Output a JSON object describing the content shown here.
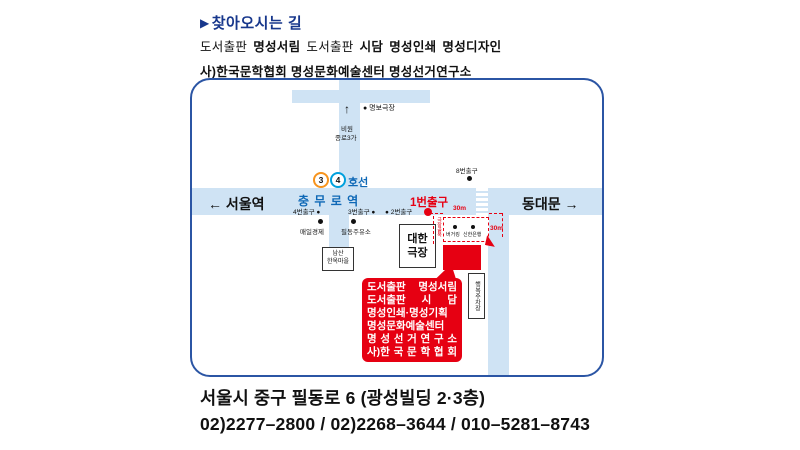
{
  "colors": {
    "accent_red": "#e60012",
    "navy_blue": "#17378c",
    "map_border_blue": "#2b55a4",
    "road_blue": "#cfe3f4",
    "station_blue": "#0e68b6",
    "line3_orange": "#f7941d",
    "line4_blue": "#00a0dd"
  },
  "header": {
    "title_icon": "▶",
    "title": "찾아오시는 길",
    "orgs_line1_segments": [
      {
        "text": "도서출판",
        "style": "serif"
      },
      {
        "text": "명성서림",
        "style": "bold"
      },
      {
        "text": "도서출판",
        "style": "serif"
      },
      {
        "text": "시담",
        "style": "bold"
      },
      {
        "text": "명성인쇄",
        "style": "bold"
      },
      {
        "text": "명성디자인",
        "style": "bold"
      }
    ],
    "orgs_line2": "사)한국문학협회 명성문화예술센터 명성선거연구소"
  },
  "map": {
    "north_road": {
      "up_arrow": "↑",
      "dest_line1": "비원",
      "dest_line2": "종로3가",
      "theater": "● 명보극장"
    },
    "station": {
      "line3_num": "3",
      "line4_num": "4",
      "line_suffix": "호선",
      "name": "충 무 로 역"
    },
    "directions": {
      "west": "← 서울역",
      "east": "동대문 →"
    },
    "exits": {
      "exit8": "8번출구",
      "exit1": "1번출구",
      "exit4": "4번출구 ●",
      "exit3": "3번출구 ●",
      "exit2": "● 2번출구"
    },
    "landmarks": {
      "maeil": "매일경제",
      "gas_station": "필동주유소",
      "namsan_line1": "남산",
      "namsan_line2": "한옥마을",
      "daehan_line1": "대한",
      "daehan_line2": "극장",
      "burger": "버거킹",
      "bank": "신한은행",
      "alley": "극장골목",
      "parking": "행복주차장"
    },
    "route": {
      "dist1": "30m",
      "dist2": "30m"
    },
    "bubble": {
      "lines": [
        "도서출판 명성서림",
        "도서출판 시 담",
        "명성인쇄·명성기획",
        "명성문화예술센터",
        "명 성 선 거 연 구 소",
        "사)한 국 문 학 협 회"
      ]
    }
  },
  "footer": {
    "address": "서울시 중구 필동로 6 (광성빌딩 2·3층)",
    "phones": "02)2277–2800 / 02)2268–3644 / 010–5281–8743"
  }
}
